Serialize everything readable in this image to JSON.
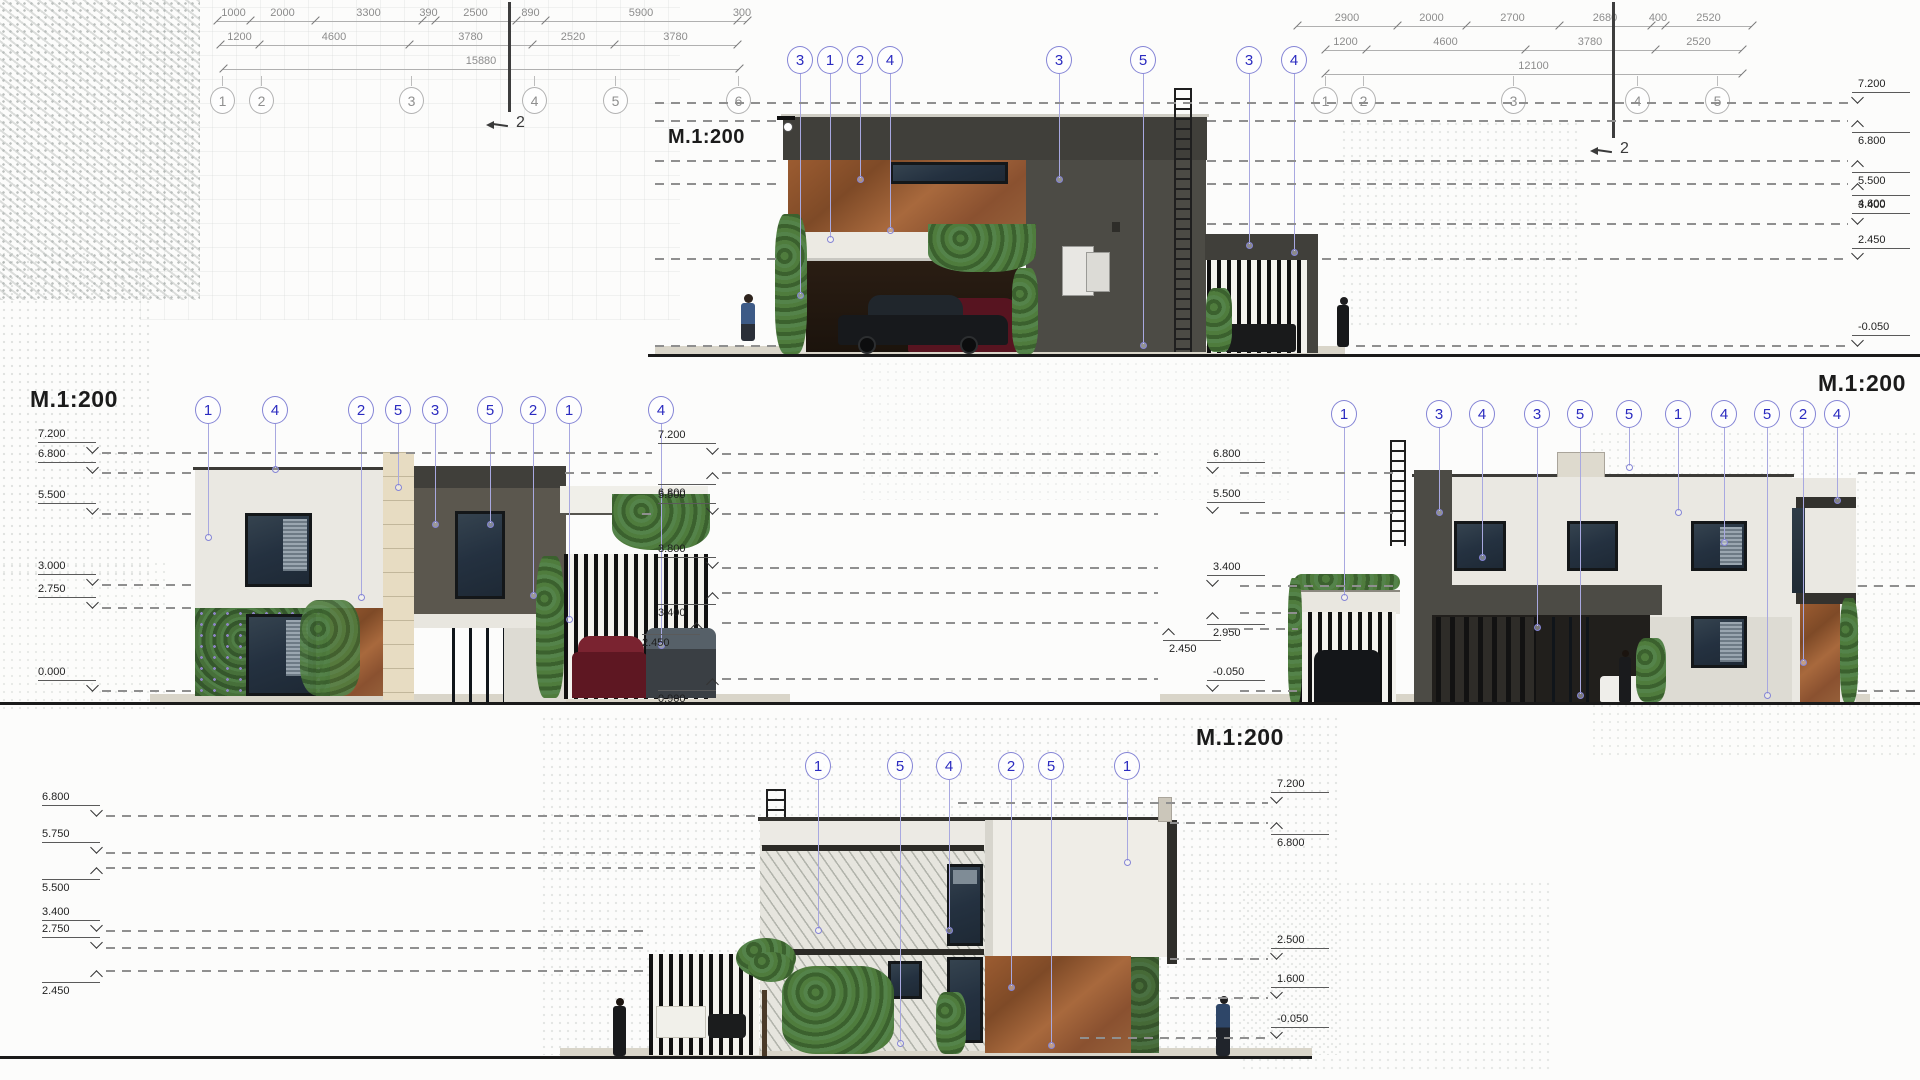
{
  "title": "House elevations drawing sheet, scale 1:200",
  "colors": {
    "callout_blue": "#2b2bc0",
    "grid_gray": "#8f8f8f",
    "level_text": "#1f1f1f",
    "charcoal_wall": "#4c4b45",
    "corten_wall": "#96582f",
    "white_wall": "#eae8e2",
    "vegetation_green": "#4f7c3d",
    "ground_line": "#1a1a1a"
  },
  "scale_labels": [
    {
      "text": "M.1:200",
      "x": 668,
      "y": 126,
      "size": 20
    },
    {
      "text": "M.1:200",
      "x": 30,
      "y": 386,
      "size": 23
    },
    {
      "text": "M.1:200",
      "x": 1818,
      "y": 370,
      "size": 23
    },
    {
      "text": "M.1:200",
      "x": 1196,
      "y": 724,
      "size": 23
    }
  ],
  "dim_blocks": [
    {
      "name": "top-left",
      "rows": [
        {
          "x": 217,
          "y": 21,
          "segs": [
            {
              "label": "1000",
              "w": 33
            },
            {
              "label": "2000",
              "w": 65
            },
            {
              "label": "3300",
              "w": 107
            },
            {
              "label": "390",
              "w": 13
            },
            {
              "label": "2500",
              "w": 81
            },
            {
              "label": "890",
              "w": 29
            },
            {
              "label": "5900",
              "w": 192
            },
            {
              "label": "300",
              "w": 10
            }
          ]
        },
        {
          "x": 220,
          "y": 45,
          "segs": [
            {
              "label": "1200",
              "w": 39
            },
            {
              "label": "4600",
              "w": 150
            },
            {
              "label": "3780",
              "w": 123
            },
            {
              "label": "2520",
              "w": 82
            },
            {
              "label": "3780",
              "w": 123
            }
          ]
        },
        {
          "x": 223,
          "y": 69,
          "segs": [
            {
              "label": "15880",
              "w": 516
            }
          ]
        }
      ]
    },
    {
      "name": "top-right",
      "rows": [
        {
          "x": 1297,
          "y": 26,
          "segs": [
            {
              "label": "2900",
              "w": 100
            },
            {
              "label": "2000",
              "w": 69
            },
            {
              "label": "2700",
              "w": 93
            },
            {
              "label": "2680",
              "w": 92
            },
            {
              "label": "400",
              "w": 14
            },
            {
              "label": "2520",
              "w": 87
            }
          ]
        },
        {
          "x": 1325,
          "y": 50,
          "segs": [
            {
              "label": "1200",
              "w": 41
            },
            {
              "label": "4600",
              "w": 159
            },
            {
              "label": "3780",
              "w": 130
            },
            {
              "label": "2520",
              "w": 87
            }
          ]
        },
        {
          "x": 1325,
          "y": 74,
          "segs": [
            {
              "label": "12100",
              "w": 417
            }
          ]
        }
      ]
    }
  ],
  "grid_bubble_rows": [
    {
      "name": "grid-top-left",
      "y": 100,
      "items": [
        {
          "n": "1",
          "x": 222
        },
        {
          "n": "2",
          "x": 261
        },
        {
          "n": "3",
          "x": 411
        },
        {
          "n": "4",
          "x": 534
        },
        {
          "n": "5",
          "x": 615
        },
        {
          "n": "6",
          "x": 738
        }
      ]
    },
    {
      "name": "grid-top-right",
      "y": 100,
      "items": [
        {
          "n": "1",
          "x": 1325
        },
        {
          "n": "2",
          "x": 1363
        },
        {
          "n": "3",
          "x": 1513
        },
        {
          "n": "4",
          "x": 1637
        },
        {
          "n": "5",
          "x": 1717
        }
      ]
    }
  ],
  "section_markers": [
    {
      "label": "2",
      "x": 508,
      "y1": 2,
      "y2": 112
    },
    {
      "label": "2",
      "x": 1612,
      "y1": 2,
      "y2": 138
    }
  ],
  "callout_groups": [
    {
      "name": "top-elevation",
      "y": 60,
      "bubbles": [
        {
          "n": "3",
          "x": 800,
          "end": 298
        },
        {
          "n": "1",
          "x": 830,
          "end": 242
        },
        {
          "n": "2",
          "x": 860,
          "end": 182
        },
        {
          "n": "4",
          "x": 890,
          "end": 233
        },
        {
          "n": "3",
          "x": 1059,
          "end": 182
        },
        {
          "n": "5",
          "x": 1143,
          "end": 348
        },
        {
          "n": "3",
          "x": 1249,
          "end": 248
        },
        {
          "n": "4",
          "x": 1294,
          "end": 255
        }
      ]
    },
    {
      "name": "middle-left-elevation",
      "y": 410,
      "bubbles": [
        {
          "n": "1",
          "x": 208,
          "end": 540
        },
        {
          "n": "4",
          "x": 275,
          "end": 472
        },
        {
          "n": "2",
          "x": 361,
          "end": 600
        },
        {
          "n": "5",
          "x": 398,
          "end": 490
        },
        {
          "n": "3",
          "x": 435,
          "end": 527
        },
        {
          "n": "5",
          "x": 490,
          "end": 527
        },
        {
          "n": "2",
          "x": 533,
          "end": 598
        },
        {
          "n": "1",
          "x": 569,
          "end": 622
        },
        {
          "n": "4",
          "x": 661,
          "end": 648
        }
      ]
    },
    {
      "name": "middle-right-elevation",
      "y": 414,
      "bubbles": [
        {
          "n": "1",
          "x": 1344,
          "end": 600
        },
        {
          "n": "3",
          "x": 1439,
          "end": 515
        },
        {
          "n": "4",
          "x": 1482,
          "end": 560
        },
        {
          "n": "3",
          "x": 1537,
          "end": 630
        },
        {
          "n": "5",
          "x": 1580,
          "end": 698
        },
        {
          "n": "5",
          "x": 1629,
          "end": 470
        },
        {
          "n": "1",
          "x": 1678,
          "end": 515
        },
        {
          "n": "4",
          "x": 1724,
          "end": 545
        },
        {
          "n": "5",
          "x": 1767,
          "end": 698
        },
        {
          "n": "2",
          "x": 1803,
          "end": 665
        },
        {
          "n": "4",
          "x": 1837,
          "end": 503
        }
      ]
    },
    {
      "name": "bottom-elevation",
      "y": 766,
      "bubbles": [
        {
          "n": "1",
          "x": 818,
          "end": 933
        },
        {
          "n": "5",
          "x": 900,
          "end": 1046
        },
        {
          "n": "4",
          "x": 949,
          "end": 933
        },
        {
          "n": "2",
          "x": 1011,
          "end": 990
        },
        {
          "n": "5",
          "x": 1051,
          "end": 1048
        },
        {
          "n": "1",
          "x": 1127,
          "end": 865
        }
      ]
    }
  ],
  "level_groups": [
    {
      "name": "top-elevation-levels",
      "side": "R",
      "mx": 1852,
      "levels": [
        {
          "label": "7.200",
          "y": 102,
          "segs": [
            [
              655,
              1848
            ]
          ]
        },
        {
          "label": "6.800",
          "y": 120,
          "pos": "below",
          "segs": [
            [
              655,
              783
            ],
            [
              1207,
              1848
            ]
          ]
        },
        {
          "label": "5.500",
          "y": 160,
          "pos": "below",
          "segs": [
            [
              655,
              783
            ],
            [
              1207,
              1848
            ]
          ]
        },
        {
          "label": "4.600",
          "y": 183,
          "pos": "below",
          "segs": [
            [
              655,
              783
            ],
            [
              1207,
              1848
            ]
          ]
        },
        {
          "label": "3.400",
          "y": 223,
          "segs": [
            [
              1207,
              1848
            ]
          ]
        },
        {
          "label": "2.450",
          "y": 258,
          "segs": [
            [
              655,
              783
            ],
            [
              1322,
              1848
            ]
          ]
        },
        {
          "label": "-0.050",
          "y": 345,
          "segs": [
            [
              655,
              783
            ],
            [
              1356,
              1848
            ]
          ]
        }
      ]
    },
    {
      "name": "middle-left-levels",
      "side": "L",
      "mx": 96,
      "levels": [
        {
          "label": "7.200",
          "y": 452,
          "segs": [
            [
              102,
              652
            ]
          ]
        },
        {
          "label": "6.800",
          "y": 472,
          "segs": [
            [
              102,
              195
            ],
            [
              565,
              652
            ]
          ]
        },
        {
          "label": "5.500",
          "y": 513,
          "segs": [
            [
              102,
              195
            ],
            [
              642,
              652
            ]
          ]
        },
        {
          "label": "3.000",
          "y": 584,
          "segs": [
            [
              102,
              195
            ]
          ]
        },
        {
          "label": "2.750",
          "y": 607,
          "segs": [
            [
              102,
              195
            ]
          ]
        },
        {
          "label": "0.000",
          "y": 690,
          "segs": [
            [
              102,
              192
            ]
          ]
        }
      ]
    },
    {
      "name": "middle-center-levels",
      "side": "L",
      "mx": 716,
      "levels": [
        {
          "label": "7.200",
          "y": 453,
          "segs": [
            [
              722,
              1158
            ]
          ]
        },
        {
          "label": "6.800",
          "y": 472,
          "pos": "below",
          "segs": [
            [
              722,
              1158
            ]
          ]
        },
        {
          "label": "5.500",
          "y": 513,
          "segs": [
            [
              722,
              1158
            ]
          ]
        },
        {
          "label": "3.800",
          "y": 567,
          "segs": [
            [
              722,
              1158
            ]
          ]
        },
        {
          "label": "3.400",
          "y": 592,
          "pos": "below",
          "segs": [
            [
              722,
              1158
            ]
          ]
        },
        {
          "label": "2.450",
          "y": 622,
          "pos": "below",
          "mx": 700,
          "segs": [
            [
              722,
              1158
            ]
          ]
        },
        {
          "label": "0.900",
          "y": 678,
          "pos": "below",
          "segs": [
            [
              722,
              1158
            ]
          ]
        }
      ]
    },
    {
      "name": "middle-right-levels",
      "side": "R",
      "mx": 1207,
      "levels": [
        {
          "label": "6.800",
          "y": 472,
          "segs": [
            [
              1240,
              1396
            ],
            [
              1858,
              1918
            ]
          ]
        },
        {
          "label": "5.500",
          "y": 512,
          "segs": [
            [
              1240,
              1396
            ]
          ]
        },
        {
          "label": "3.400",
          "y": 585,
          "segs": [
            [
              1240,
              1396
            ],
            [
              1858,
              1918
            ]
          ]
        },
        {
          "label": "2.950",
          "y": 612,
          "pos": "below",
          "segs": [
            [
              1240,
              1298
            ]
          ]
        },
        {
          "label": "2.450",
          "y": 628,
          "pos": "below",
          "mx": 1163,
          "segs": [
            [
              1228,
              1298
            ]
          ]
        },
        {
          "label": "-0.050",
          "y": 690,
          "segs": [
            [
              1240,
              1298
            ],
            [
              1858,
              1918
            ]
          ]
        }
      ]
    },
    {
      "name": "bottom-left-levels",
      "side": "L",
      "mx": 100,
      "levels": [
        {
          "label": "6.800",
          "y": 815,
          "segs": [
            [
              106,
              756
            ]
          ]
        },
        {
          "label": "5.750",
          "y": 852,
          "segs": [
            [
              106,
              756
            ]
          ]
        },
        {
          "label": "5.500",
          "y": 867,
          "pos": "below",
          "segs": [
            [
              106,
              756
            ]
          ]
        },
        {
          "label": "3.400",
          "y": 930,
          "segs": [
            [
              106,
              648
            ]
          ]
        },
        {
          "label": "2.750",
          "y": 947,
          "segs": [
            [
              106,
              648
            ]
          ]
        },
        {
          "label": "2.450",
          "y": 970,
          "pos": "below",
          "segs": [
            [
              106,
              648
            ]
          ]
        }
      ]
    },
    {
      "name": "bottom-right-levels",
      "side": "R",
      "mx": 1271,
      "levels": [
        {
          "label": "7.200",
          "y": 802,
          "segs": [
            [
              958,
              1268
            ]
          ]
        },
        {
          "label": "6.800",
          "y": 822,
          "pos": "below",
          "segs": [
            [
              1170,
              1268
            ]
          ]
        },
        {
          "label": "2.500",
          "y": 958,
          "segs": [
            [
              1170,
              1268
            ]
          ]
        },
        {
          "label": "1.600",
          "y": 997,
          "segs": [
            [
              1170,
              1268
            ]
          ]
        },
        {
          "label": "-0.050",
          "y": 1037,
          "segs": [
            [
              1080,
              1268
            ]
          ]
        }
      ]
    }
  ],
  "ground_lines": [
    {
      "y": 354,
      "x1": 648,
      "x2": 1920,
      "h": 3
    },
    {
      "y": 702,
      "x1": 0,
      "x2": 1920,
      "h": 3
    },
    {
      "y": 1056,
      "x1": 0,
      "x2": 1312,
      "h": 3
    }
  ]
}
